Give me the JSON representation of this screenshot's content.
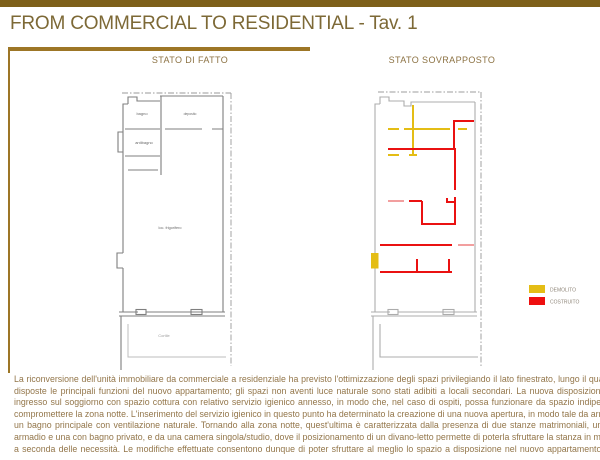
{
  "header": {
    "title": "FROM COMMERCIAL TO RESIDENTIAL - Tav. 1"
  },
  "colors": {
    "top_bar": "#7e6019",
    "rule": "#9d7626",
    "title_text": "#7d6936",
    "body_text": "#93764a",
    "plan_gray": "#7f7f7f",
    "plan_gray_light": "#acacac",
    "demolito_yellow": "#e4bd15",
    "costruito_red": "#ea1111"
  },
  "plans": {
    "left": {
      "title": "STATO DI FATTO",
      "labels": {
        "room1": "bagno",
        "room2": "antibagno",
        "room3": "deposito",
        "main": "loc. frigorifero",
        "courtyard": "Cortile"
      }
    },
    "right": {
      "title": "STATO SOVRAPPOSTO"
    }
  },
  "legend": {
    "items": [
      {
        "label": "DEMOLITO",
        "color": "#e4bd15"
      },
      {
        "label": "COSTRUITO",
        "color": "#ee0f0f"
      }
    ]
  },
  "description": {
    "lines": [
      "La riconversione dell'unità immobiliare da commerciale a residenziale ha previsto l'ottimizzazione degli spazi privilegiando il lato finestrato, lungo il quale sono state",
      "disposte le principali funzioni del nuovo appartamento; gli spazi non aventi luce naturale sono stati adibiti a locali secondari. La nuova disposizione prevede un",
      "ingresso sul soggiorno con spazio cottura con relativo servizio igienico annesso, in modo che, nel caso di ospiti, possa funzionare da spazio  indipendente e non",
      "compromettere la zona notte. L'inserimento del servizio igienico in questo punto ha determinato la creazione di una nuova apertura, in modo tale da arrivare ad avere",
      "un bagno principale con ventilazione naturale. Tornando alla zona notte, quest'ultima è caratterizzata dalla presenza di due stanze matrimoniali, una con cabina",
      "armadio e una con bagno privato, e da una camera singola/studio, dove il posizionamento di un divano-letto permette di poterla sfruttare la stanza in maniera diversa",
      "a seconda delle necessità. Le modifiche effettuate consentono dunque di poter sfruttare al meglio lo spazio a disposizione nel nuovo appartamento residenziale."
    ]
  }
}
